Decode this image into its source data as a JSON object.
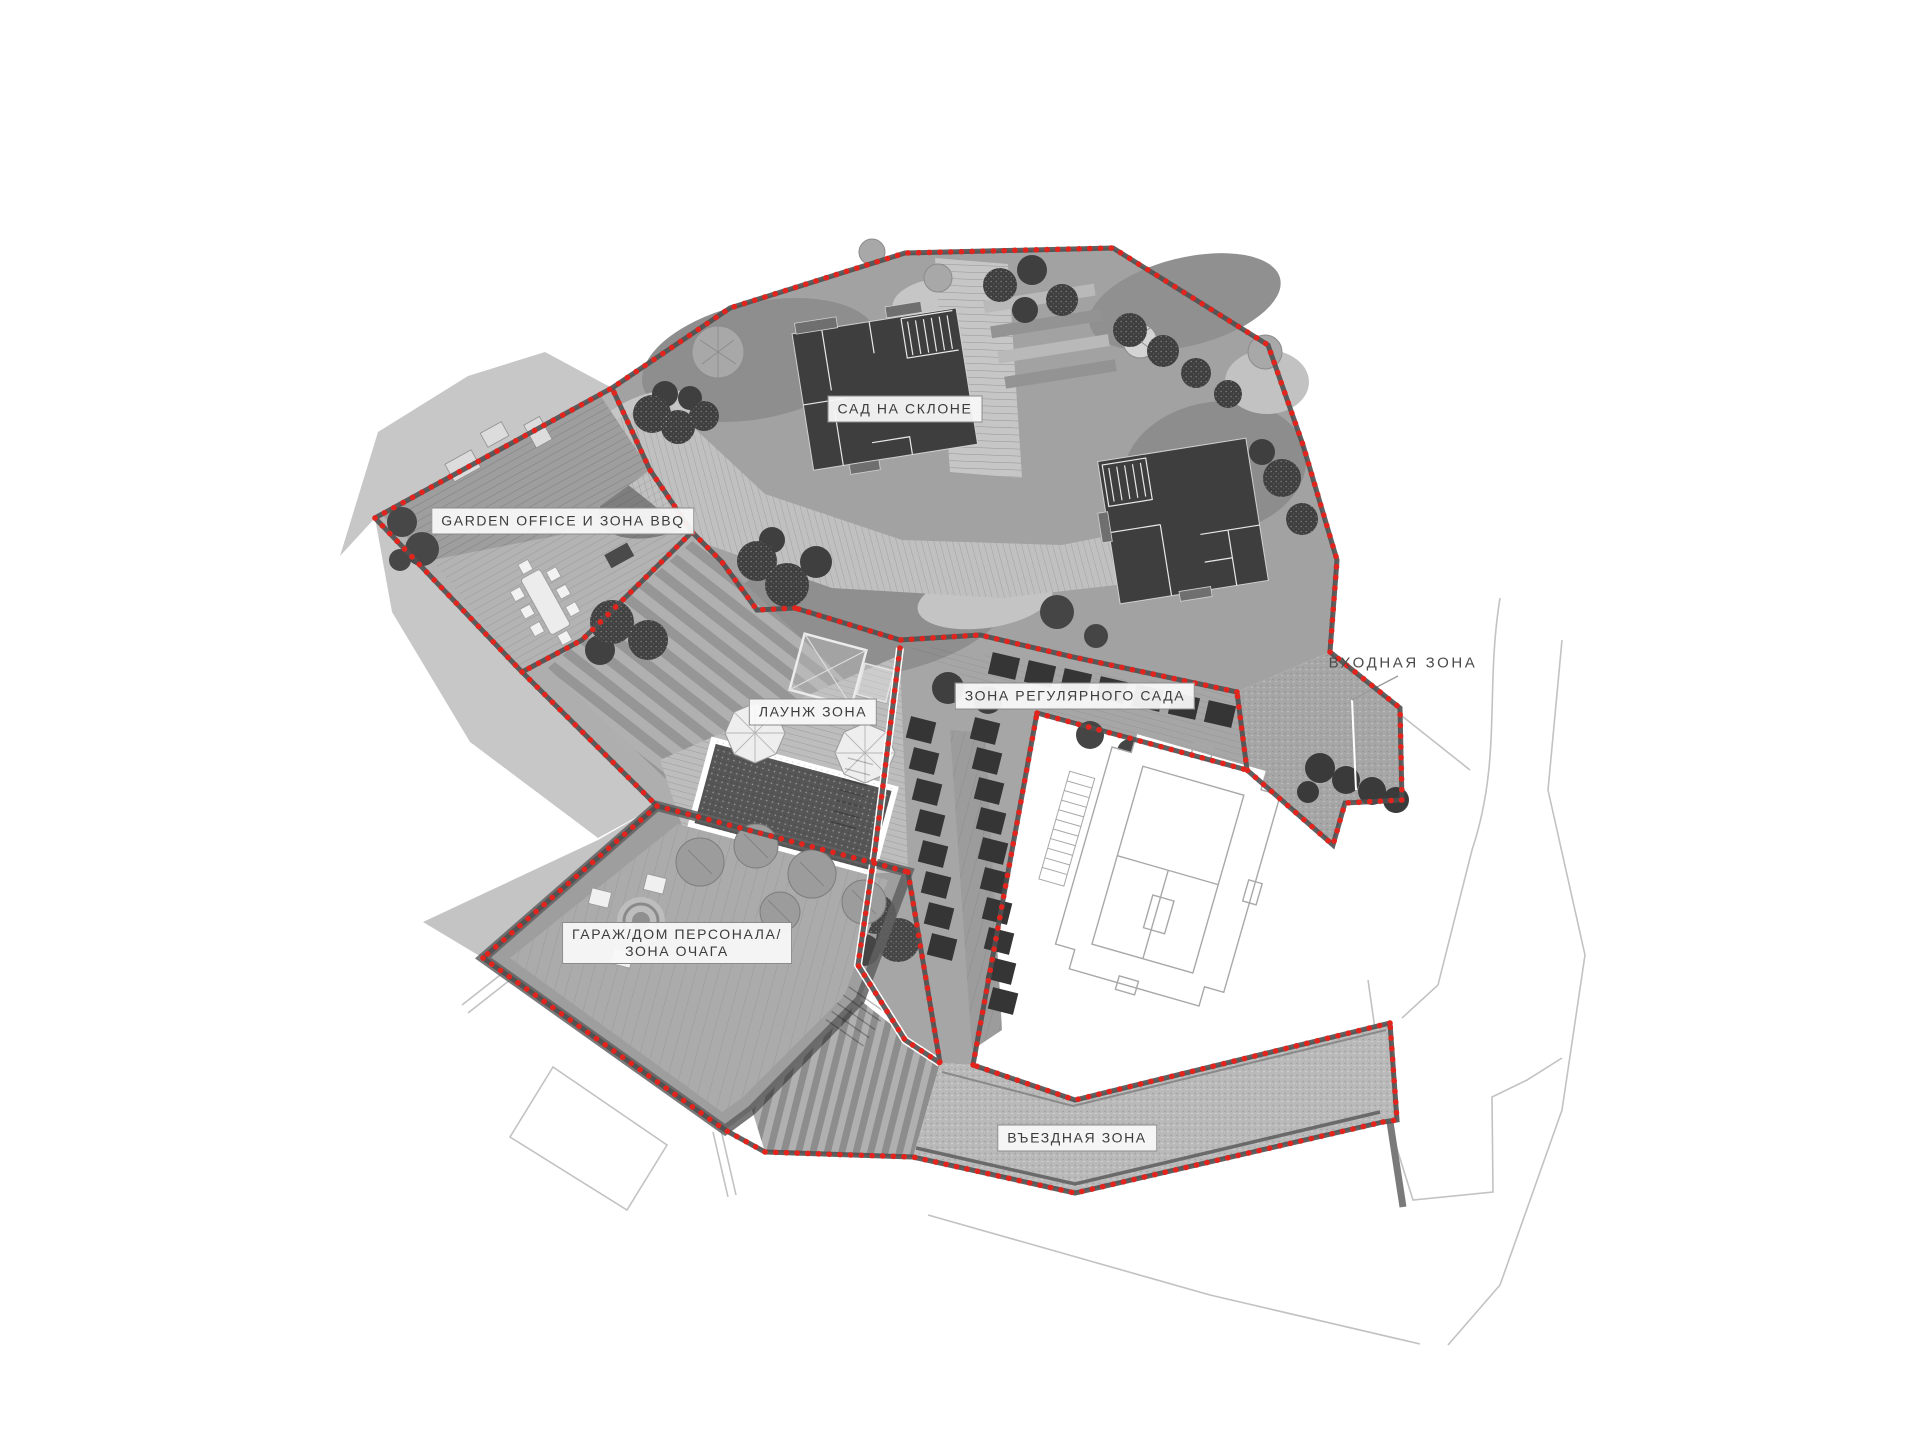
{
  "page": {
    "type": "landscape-masterplan-screenshot",
    "language": "ru",
    "background": "#ffffff"
  },
  "zones": [
    {
      "id": "slope-garden",
      "label": "САД НА СКЛОНЕ"
    },
    {
      "id": "garden-office-bbq",
      "label": "GARDEN OFFICE И ЗОНА BBQ"
    },
    {
      "id": "lounge",
      "label": "ЛАУНЖ ЗОНА"
    },
    {
      "id": "regular-garden",
      "label": "ЗОНА РЕГУЛЯРНОГО САДА"
    },
    {
      "id": "entrance",
      "label": "ВХОДНАЯ ЗОНА"
    },
    {
      "id": "garage-staff-hearth",
      "label_line1": "ГАРАЖ/ДОМ ПЕРСОНАЛА/",
      "label_line2": "ЗОНА ОЧАГА"
    },
    {
      "id": "driveway",
      "label": "ВЪЕЗДНАЯ ЗОНА"
    }
  ],
  "colors": {
    "boundary_dots": "#e3241d",
    "boundary_band": "#4f4f4f",
    "building_fill": "#3e3e3e",
    "plan_gray": "#a2a2a2",
    "deck_gray": "#c0c0c0",
    "gravel_gray": "#b9b9b9",
    "shadow_gray": "#c7c7c7",
    "hedge_dark": "#353535",
    "label_bg": "#f8f8f8",
    "label_border": "#8b8b8b",
    "label_text": "#3c3c3c",
    "context_outline": "#c2c2c2"
  }
}
